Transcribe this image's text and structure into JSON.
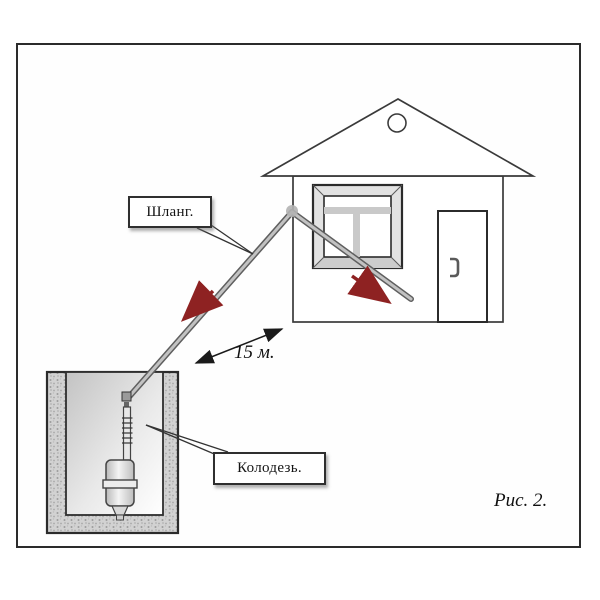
{
  "figure": {
    "caption": "Рис. 2.",
    "distance_label": "15 м.",
    "labels": {
      "hose": "Шланг.",
      "well": "Колодезь."
    }
  },
  "icons": {
    "flow_arrow": "red-flow-arrow",
    "distance_arrow": "double-headed-arrow"
  },
  "colors": {
    "frame_line": "#2b2b2b",
    "drawing_line": "#3a3a3a",
    "hose_gray": "#c2c2c2",
    "flow_arrow_red": "#8e2222",
    "well_concrete": "#d0d0d0",
    "window_muntin": "#c9c9c9"
  }
}
